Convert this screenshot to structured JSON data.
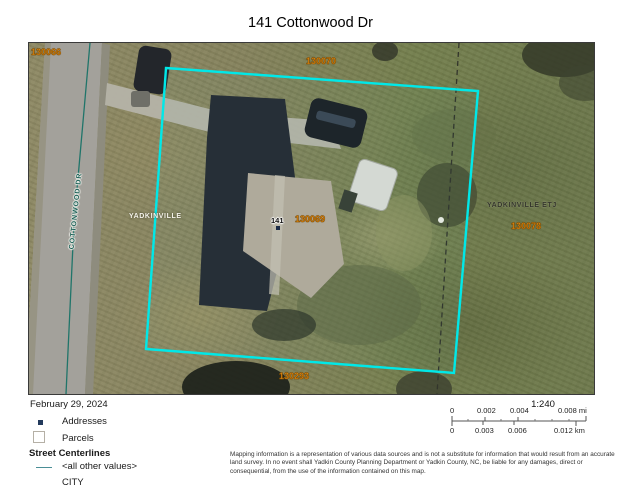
{
  "page_title": "141 Cottonwood Dr",
  "map": {
    "parcel_labels": [
      {
        "id": "130066"
      },
      {
        "id": "130070"
      },
      {
        "id": "130069"
      },
      {
        "id": "130078"
      },
      {
        "id": "130293"
      }
    ],
    "place_labels": {
      "city": "YADKINVILLE",
      "etj": "YADKINVILLE ETJ"
    },
    "street_label": "COTTONWOOD DR",
    "address_label": "141",
    "colors": {
      "parcel_boundary": "#00e8e8",
      "parcel_label": "#f79413",
      "street_centerline": "#20756a",
      "address_point": "#1b2b47"
    }
  },
  "legend": {
    "date": "February 29, 2024",
    "items": [
      {
        "label": "Addresses",
        "symbol": "address-point-square"
      },
      {
        "label": "Parcels",
        "symbol": "parcel-outline-square"
      }
    ],
    "group_header": "Street Centerlines",
    "street_items": [
      {
        "label": "<all other values>",
        "symbol": "centerline"
      },
      {
        "label": "CITY",
        "symbol": "centerline"
      }
    ]
  },
  "scale": {
    "ratio": "1:240",
    "mi": [
      "0",
      "0.002",
      "0.004",
      "0.008 mi"
    ],
    "km": [
      "0",
      "0.003",
      "0.006",
      "0.012 km"
    ]
  },
  "disclaimer": "Mapping information is a representation of various data sources and is not a substitute for information that would result from an accurate land survey. In no event shall Yadkin County Planning Department or Yadkin County, NC, be liable for any damages, direct or consequential, from the use of the information contained on this map."
}
